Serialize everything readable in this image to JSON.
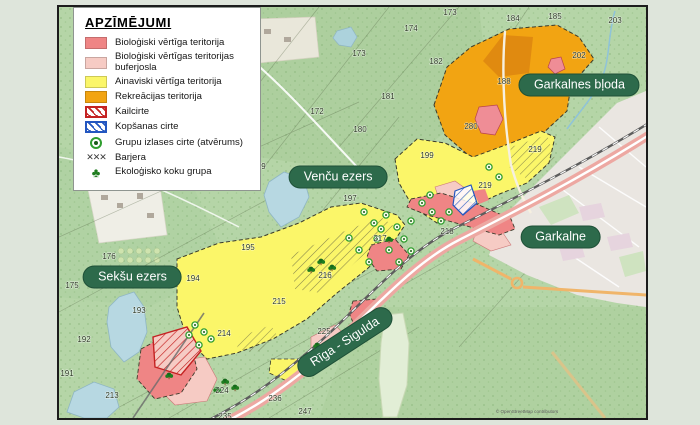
{
  "colors": {
    "page_bg": "#dee5db",
    "forest": "#b5d5a7",
    "bio_valuable": "#ef8585",
    "bio_buffer": "#f6cbc4",
    "scenic": "#fbf669",
    "recreation": "#f2a412",
    "kailcirte": "#c42222",
    "kopsanas": "#2356c0",
    "group_cut": "#2f9e2f",
    "barrier": "#3a3a3a",
    "eco_tree": "#1f7d1f",
    "lake": "#b7d8e2",
    "pill": "#2d6a4b"
  },
  "legend": {
    "title": "APZĪMĒJUMI",
    "items": [
      {
        "label": "Bioloģiski vērtīga teritorija",
        "swatch": "solid",
        "color": "#ef8585"
      },
      {
        "label": "Bioloģiski vērtīgas teritorijas buferjosla",
        "swatch": "solid",
        "color": "#f6cbc4"
      },
      {
        "label": "Ainaviski vērtīga teritorija",
        "swatch": "solid",
        "color": "#fbf669"
      },
      {
        "label": "Rekreācijas teritorija",
        "swatch": "solid",
        "color": "#f2a412"
      },
      {
        "label": "Kailcirte",
        "swatch": "hatch",
        "color": "#c42222"
      },
      {
        "label": "Kopšanas cirte",
        "swatch": "hatch",
        "color": "#2356c0"
      },
      {
        "label": "Grupu izlases cirte (atvērums)",
        "swatch": "circle",
        "color": "#2f9e2f"
      },
      {
        "label": "Barjera",
        "swatch": "barrier",
        "color": "#3a3a3a",
        "glyph": "✕✕✕"
      },
      {
        "label": "Ekoloģisko koku grupa",
        "swatch": "tree",
        "color": "#1f7d1f",
        "glyph": "♣"
      }
    ]
  },
  "map": {
    "labels": [
      {
        "text": "Garkalnes bļoda",
        "x": 524,
        "y": 79,
        "rot": 0
      },
      {
        "text": "Venču ezers",
        "x": 281,
        "y": 172,
        "rot": 0
      },
      {
        "text": "Garkalne",
        "x": 505,
        "y": 232,
        "rot": 0
      },
      {
        "text": "Sekšu ezers",
        "x": 74,
        "y": 273,
        "rot": 0
      },
      {
        "text": "Rīga - Sigulda",
        "x": 288,
        "y": 338,
        "rot": -33
      }
    ],
    "numbers": [
      {
        "t": "173",
        "x": 391,
        "y": 8
      },
      {
        "t": "174",
        "x": 352,
        "y": 24
      },
      {
        "t": "184",
        "x": 454,
        "y": 14
      },
      {
        "t": "185",
        "x": 496,
        "y": 12
      },
      {
        "t": "203",
        "x": 556,
        "y": 16
      },
      {
        "t": "202",
        "x": 520,
        "y": 51
      },
      {
        "t": "182",
        "x": 377,
        "y": 57
      },
      {
        "t": "173",
        "x": 300,
        "y": 49
      },
      {
        "t": "181",
        "x": 329,
        "y": 92
      },
      {
        "t": "172",
        "x": 258,
        "y": 107
      },
      {
        "t": "180",
        "x": 301,
        "y": 125
      },
      {
        "t": "188",
        "x": 445,
        "y": 77
      },
      {
        "t": "280",
        "x": 412,
        "y": 122
      },
      {
        "t": "199",
        "x": 368,
        "y": 151
      },
      {
        "t": "219",
        "x": 476,
        "y": 145
      },
      {
        "t": "219",
        "x": 426,
        "y": 181
      },
      {
        "t": "197",
        "x": 291,
        "y": 194
      },
      {
        "t": "179",
        "x": 200,
        "y": 162
      },
      {
        "t": "218",
        "x": 388,
        "y": 227
      },
      {
        "t": "217",
        "x": 321,
        "y": 234
      },
      {
        "t": "216",
        "x": 266,
        "y": 271
      },
      {
        "t": "215",
        "x": 220,
        "y": 297
      },
      {
        "t": "195",
        "x": 189,
        "y": 243
      },
      {
        "t": "194",
        "x": 134,
        "y": 274
      },
      {
        "t": "176",
        "x": 50,
        "y": 252
      },
      {
        "t": "175",
        "x": 13,
        "y": 281
      },
      {
        "t": "193",
        "x": 80,
        "y": 306
      },
      {
        "t": "192",
        "x": 25,
        "y": 335
      },
      {
        "t": "191",
        "x": 8,
        "y": 369
      },
      {
        "t": "213",
        "x": 53,
        "y": 391
      },
      {
        "t": "214",
        "x": 165,
        "y": 329
      },
      {
        "t": "225",
        "x": 265,
        "y": 327
      },
      {
        "t": "224",
        "x": 163,
        "y": 386
      },
      {
        "t": "235",
        "x": 166,
        "y": 412
      },
      {
        "t": "236",
        "x": 216,
        "y": 394
      },
      {
        "t": "247",
        "x": 246,
        "y": 407
      }
    ],
    "attribution": "© OpenStreetMap contributors"
  }
}
